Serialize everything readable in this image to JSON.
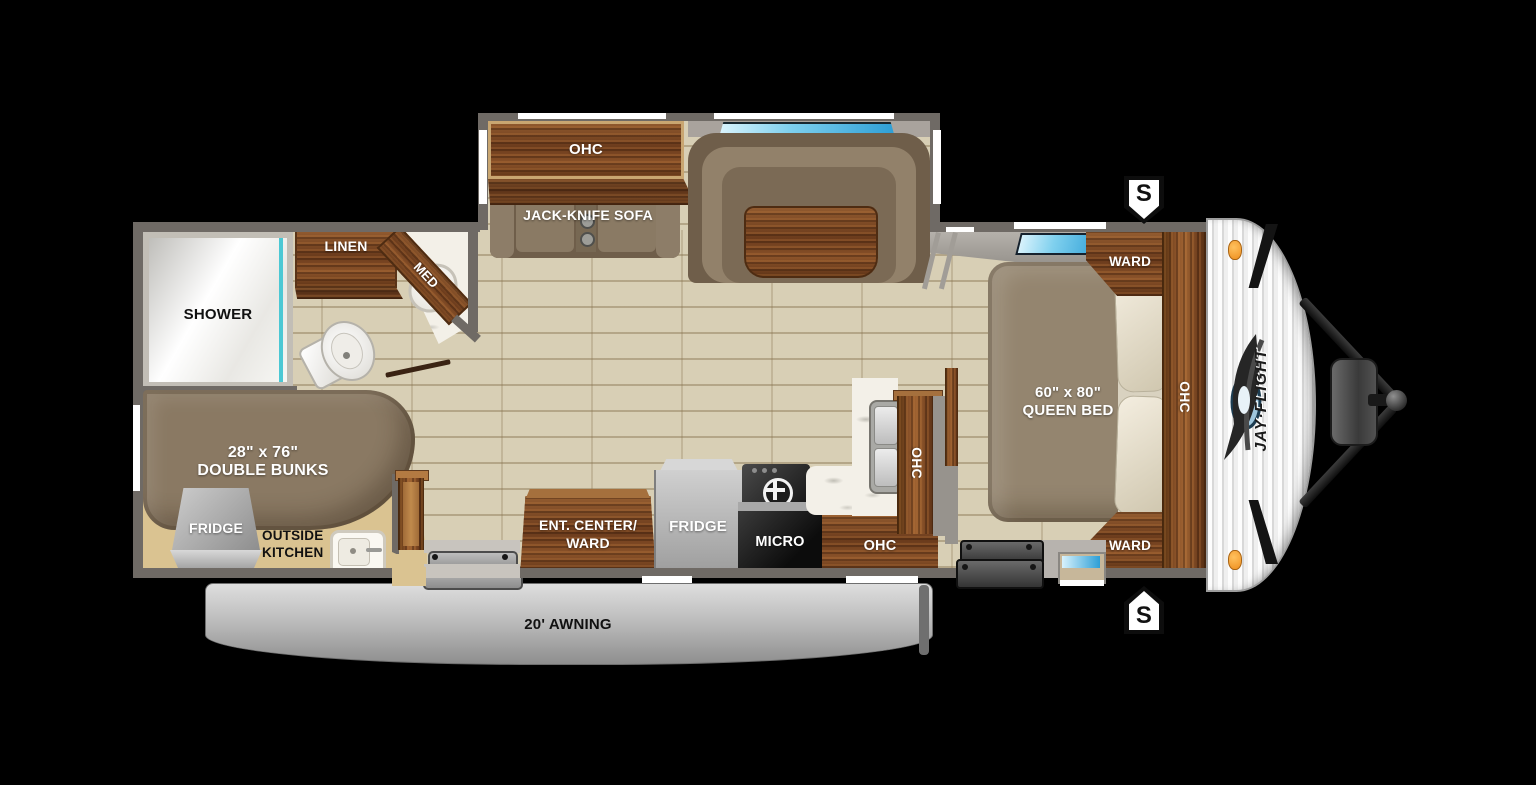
{
  "plan": {
    "slideout": {
      "ohc": "OHC",
      "sofa": "JACK-KNIFE SOFA"
    },
    "bathroom": {
      "shower": "SHOWER",
      "linen": "LINEN",
      "med": "MED"
    },
    "bunkroom": {
      "size": "28\" x 76\"",
      "name": "DOUBLE BUNKS",
      "fridge": "FRIDGE",
      "outside_line1": "OUTSIDE",
      "outside_line2": "KITCHEN"
    },
    "kitchen": {
      "entcenter_line1": "ENT. CENTER/",
      "entcenter_line2": "WARD",
      "fridge": "FRIDGE",
      "micro": "MICRO",
      "ohc_lower": "OHC",
      "ohc_upper": "OHC"
    },
    "bedroom": {
      "size": "60\" x 80\"",
      "name": "QUEEN BED",
      "ward_top": "WARD",
      "ward_bottom": "WARD",
      "ohc": "OHC"
    },
    "exterior": {
      "awning": "20' AWNING",
      "speaker_top": "S",
      "speaker_bottom": "S",
      "brand": "JAY·FLIGHT"
    },
    "colors": {
      "wall": "#6f6a65",
      "floor": "#d8cfb5",
      "wood": "#7a4a26",
      "upholstery": "#8a7963",
      "outside_kitchen_floor": "#dac391",
      "window_glass": "#2e9fd6",
      "shower_glass_teal": "#4cc8d4",
      "accent_orange": "#f0a030"
    }
  }
}
